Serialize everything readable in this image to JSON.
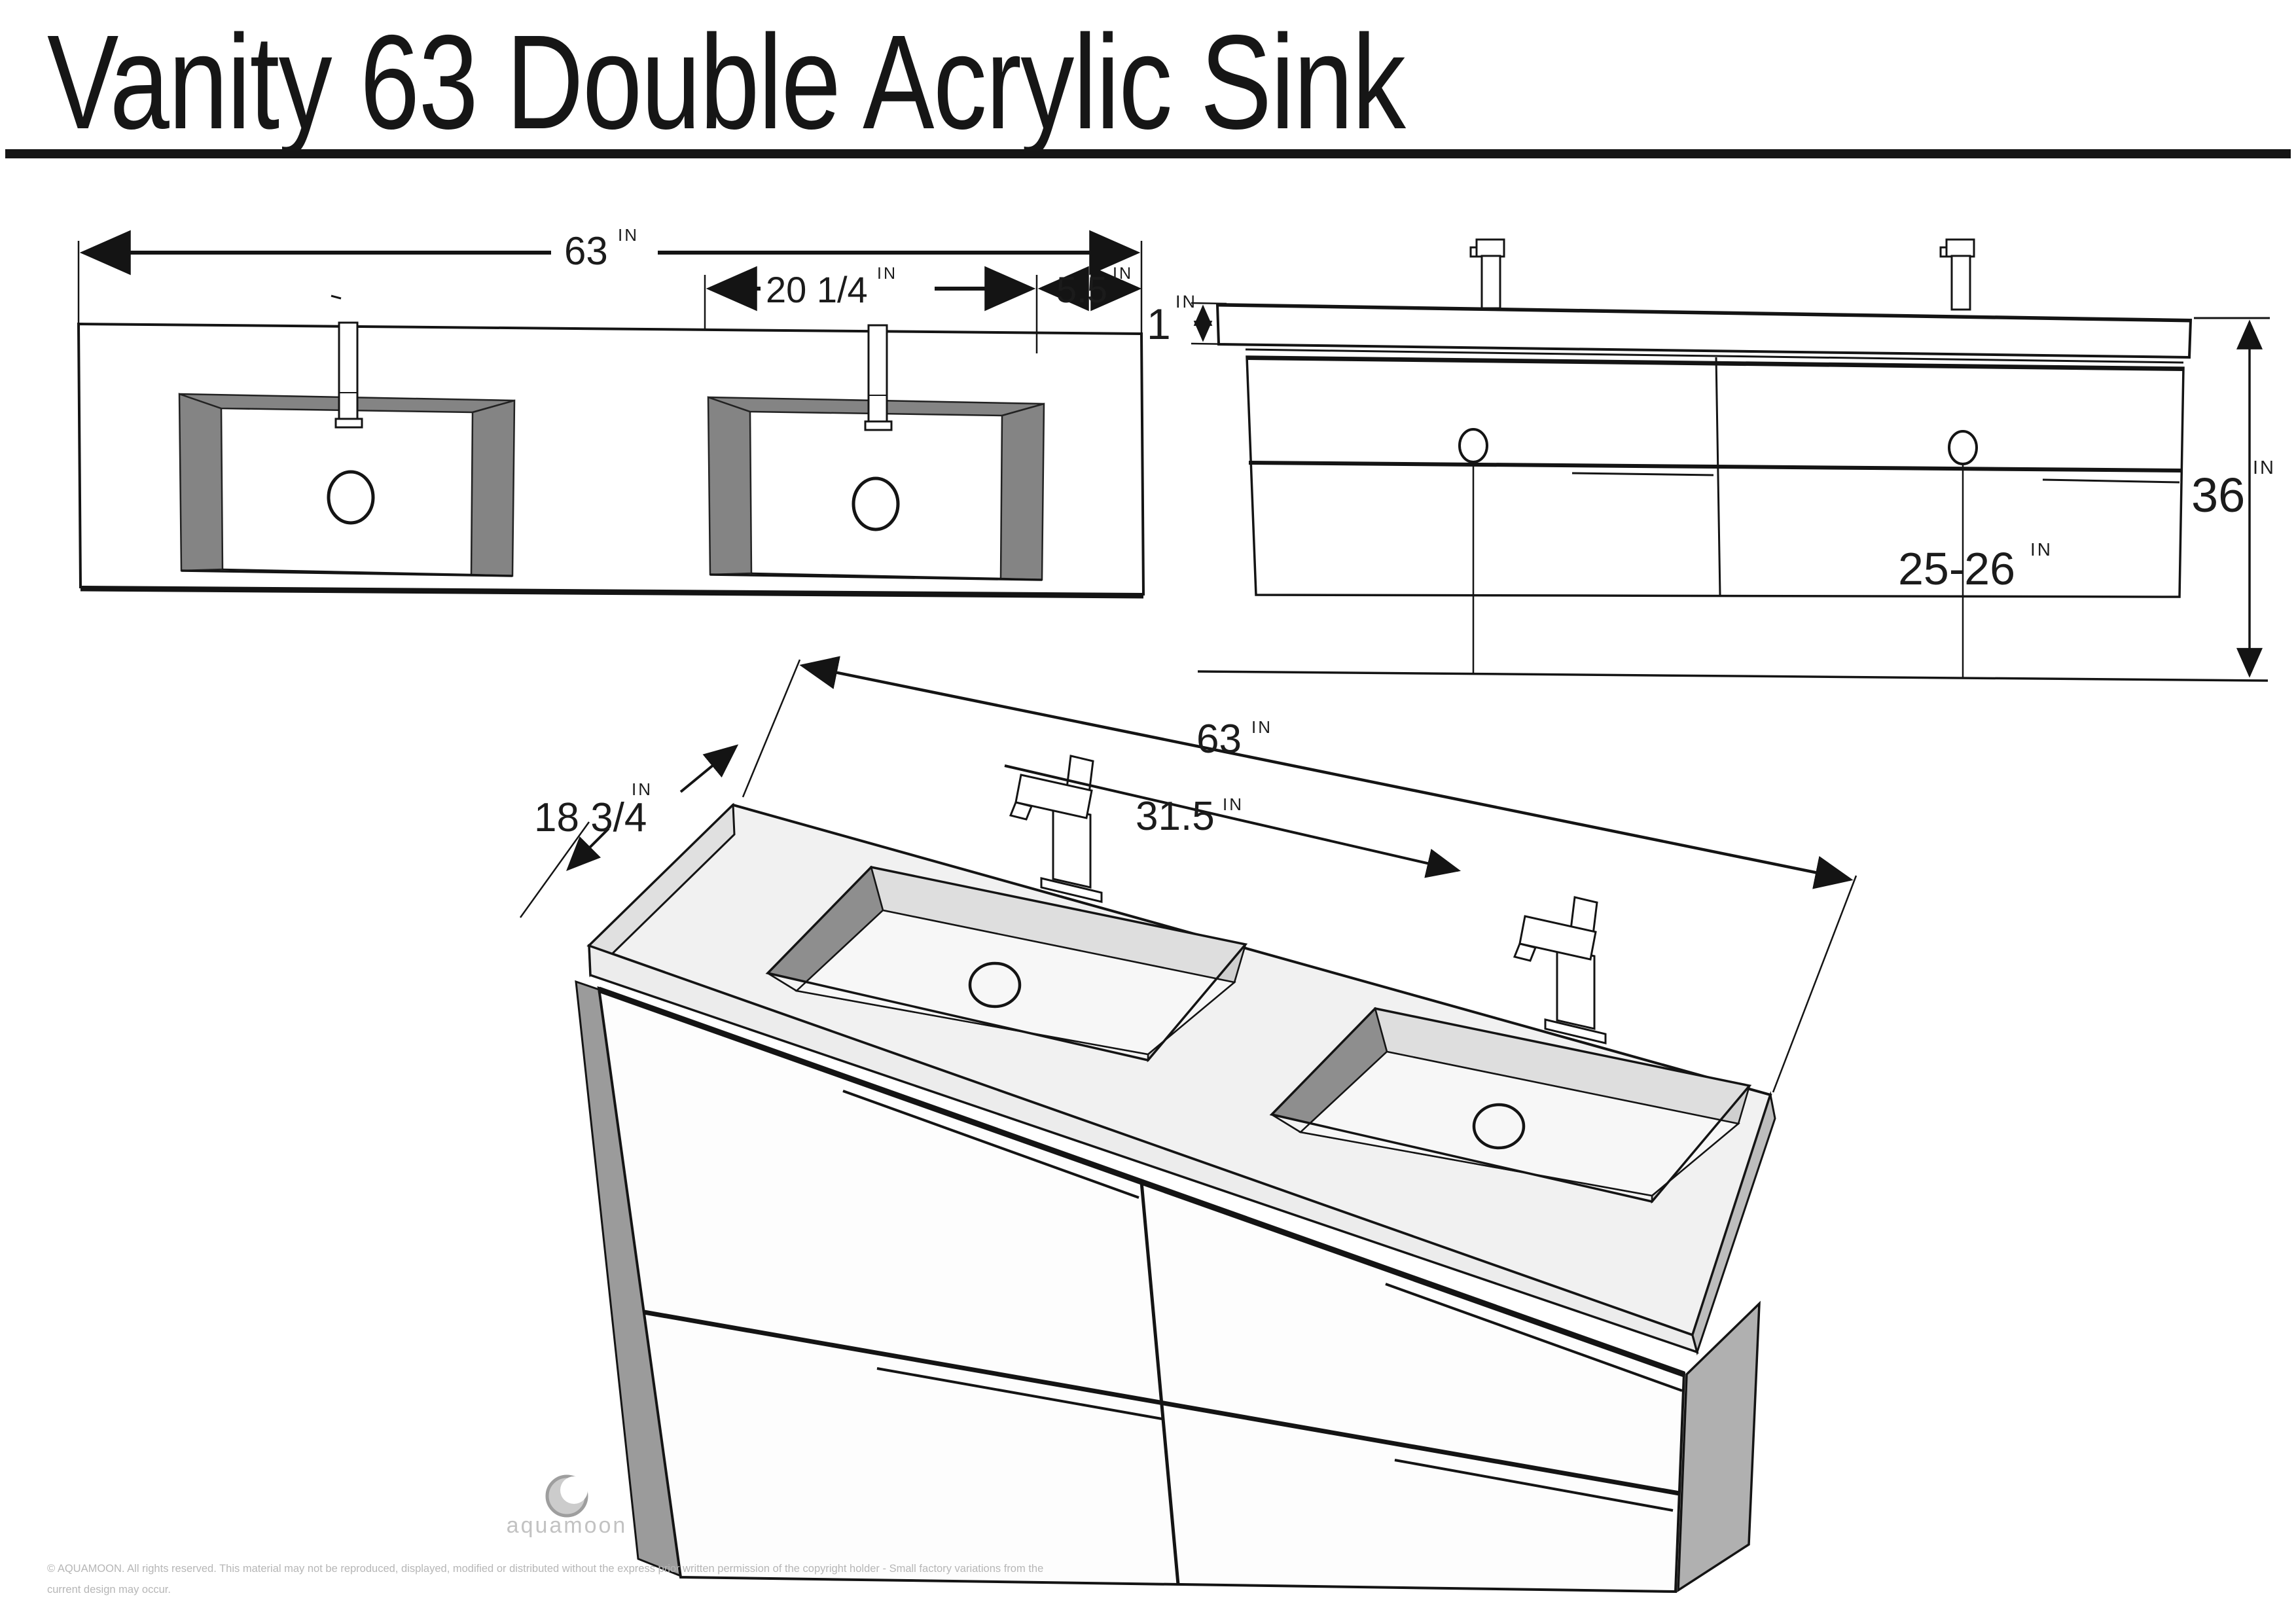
{
  "title": "Vanity 63 Double Acrylic Sink",
  "unit": "IN",
  "views": {
    "top": {
      "label_width": "63",
      "label_sink_width": "20 1/4",
      "label_edge_offset": "5.5"
    },
    "front": {
      "label_counter_thickness": "1",
      "label_total_height": "36",
      "label_drain_height": "25-26"
    },
    "perspective": {
      "label_width": "63",
      "label_faucet_spacing": "31.5",
      "label_depth": "18 3/4"
    }
  },
  "footer": {
    "brand": "aquamoon",
    "copyright_line1": "© AQUAMOON. All rights reserved. This material may not be reproduced, displayed, modified or distributed without the express prior written permission of the copyright holder - Small factory variations from the",
    "copyright_line2": "current design may occur."
  },
  "colors": {
    "line": "#141414",
    "basin_wall_dark": "#8e8e8e",
    "frame_gray": "#848484",
    "panel_gray": "#b0b0b0",
    "surface_light": "#f1f1f1",
    "footer_gray": "#b6b6b6"
  }
}
